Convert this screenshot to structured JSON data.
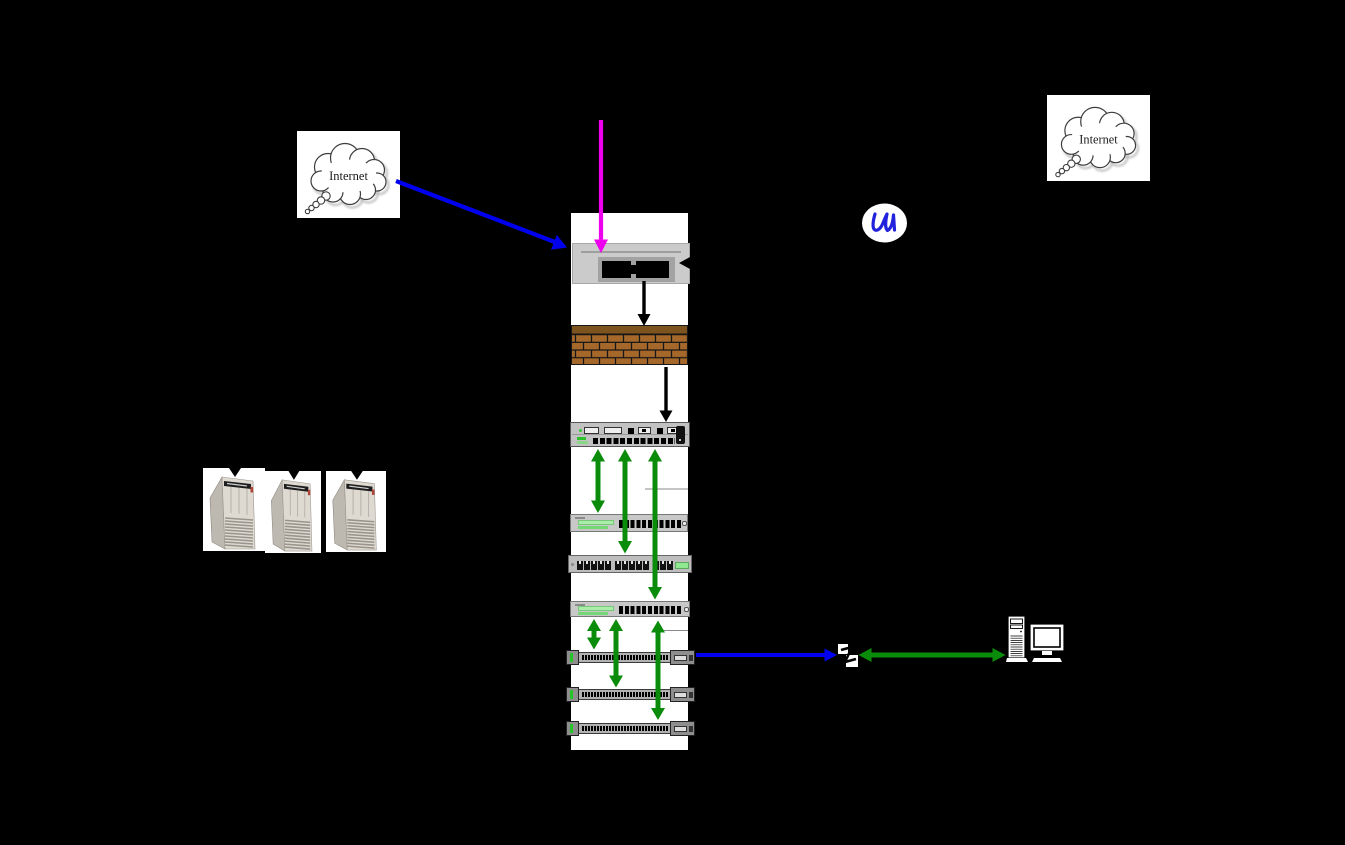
{
  "clouds": {
    "left": {
      "label": "Internet"
    },
    "right": {
      "label": "Internet"
    }
  },
  "colors": {
    "background": "#000000",
    "internet_link_blue": "#0000ee",
    "wan_feed_magenta": "#ee00ee",
    "lan_link_green": "#0a8c0a",
    "wired_black": "#000000",
    "brick": "#a5682a",
    "brick_top": "#7d541e",
    "chassis_gray": "#c6c6c6",
    "led_green": "#8fe88f",
    "rack_white": "#ffffff",
    "squiggle_blue": "#2222dd"
  },
  "nodes": [
    {
      "id": "internet-cloud-left",
      "type": "cloud",
      "label": "Internet"
    },
    {
      "id": "internet-cloud-right",
      "type": "cloud",
      "label": "Internet"
    },
    {
      "id": "cable-modem",
      "type": "modem"
    },
    {
      "id": "firewall",
      "type": "brick-wall"
    },
    {
      "id": "core-router",
      "type": "router"
    },
    {
      "id": "distribution-switch-1",
      "type": "switch"
    },
    {
      "id": "patch-panel",
      "type": "patch-panel"
    },
    {
      "id": "distribution-switch-2",
      "type": "switch"
    },
    {
      "id": "access-switch-1",
      "type": "rack-switch"
    },
    {
      "id": "access-switch-2",
      "type": "rack-switch"
    },
    {
      "id": "access-switch-3",
      "type": "rack-switch"
    },
    {
      "id": "server-1",
      "type": "tower-server"
    },
    {
      "id": "server-2",
      "type": "tower-server"
    },
    {
      "id": "server-3",
      "type": "tower-server"
    },
    {
      "id": "wall-jack",
      "type": "network-jack"
    },
    {
      "id": "workstation",
      "type": "desktop-computer"
    },
    {
      "id": "squiggle-annotation",
      "type": "handwritten-mark"
    }
  ],
  "edges": [
    {
      "from": "internet-cloud-left",
      "to": "cable-modem",
      "color": "blue",
      "arrow": "single"
    },
    {
      "from": "offscreen-top",
      "to": "cable-modem",
      "color": "magenta",
      "arrow": "single"
    },
    {
      "from": "cable-modem",
      "to": "firewall",
      "color": "black",
      "arrow": "single"
    },
    {
      "from": "firewall",
      "to": "core-router",
      "color": "black",
      "arrow": "single"
    },
    {
      "from": "core-router",
      "to": "distribution-switch-1",
      "color": "green",
      "arrow": "double"
    },
    {
      "from": "core-router",
      "to": "patch-panel",
      "color": "green",
      "arrow": "double"
    },
    {
      "from": "core-router",
      "to": "distribution-switch-2",
      "color": "green",
      "arrow": "double"
    },
    {
      "from": "distribution-switch-2",
      "to": "access-switch-1",
      "color": "green",
      "arrow": "double"
    },
    {
      "from": "distribution-switch-2",
      "to": "access-switch-2",
      "color": "green",
      "arrow": "double"
    },
    {
      "from": "distribution-switch-2",
      "to": "access-switch-3",
      "color": "green",
      "arrow": "double"
    },
    {
      "from": "access-switch-1",
      "to": "wall-jack",
      "color": "blue",
      "arrow": "single"
    },
    {
      "from": "wall-jack",
      "to": "workstation",
      "color": "green",
      "arrow": "double"
    }
  ]
}
